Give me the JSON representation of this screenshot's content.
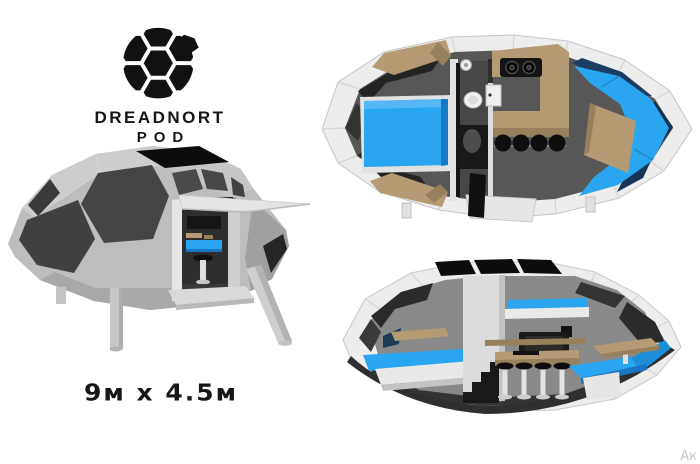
{
  "brand": {
    "icon": "hex-ball-icon",
    "name": "DREADNORT",
    "sub": "POD"
  },
  "dimensions": {
    "label": "9м x 4.5м"
  },
  "watermark": {
    "text": "Ак"
  },
  "views": {
    "exterior": "exterior-3d-render",
    "floor_plan": "top-down-floor-plan",
    "cutaway": "side-cutaway-section"
  },
  "colors": {
    "background": "#ffffff",
    "ink": "#161616",
    "accent_blue": "#2aa6f0",
    "accent_blue_dark": "#1878c8",
    "navy_glass": "#1b3d63",
    "wood_tan": "#b59b73",
    "wood_tan_dark": "#97805c",
    "shell_light": "#ededed",
    "shell_mid": "#bdbdbd",
    "shell_dark": "#9e9e9e",
    "floor_gray": "#575757",
    "window_charcoal": "#454545",
    "solar_black": "#0c0c0c",
    "watermark_gray": "#c9c9c9"
  }
}
